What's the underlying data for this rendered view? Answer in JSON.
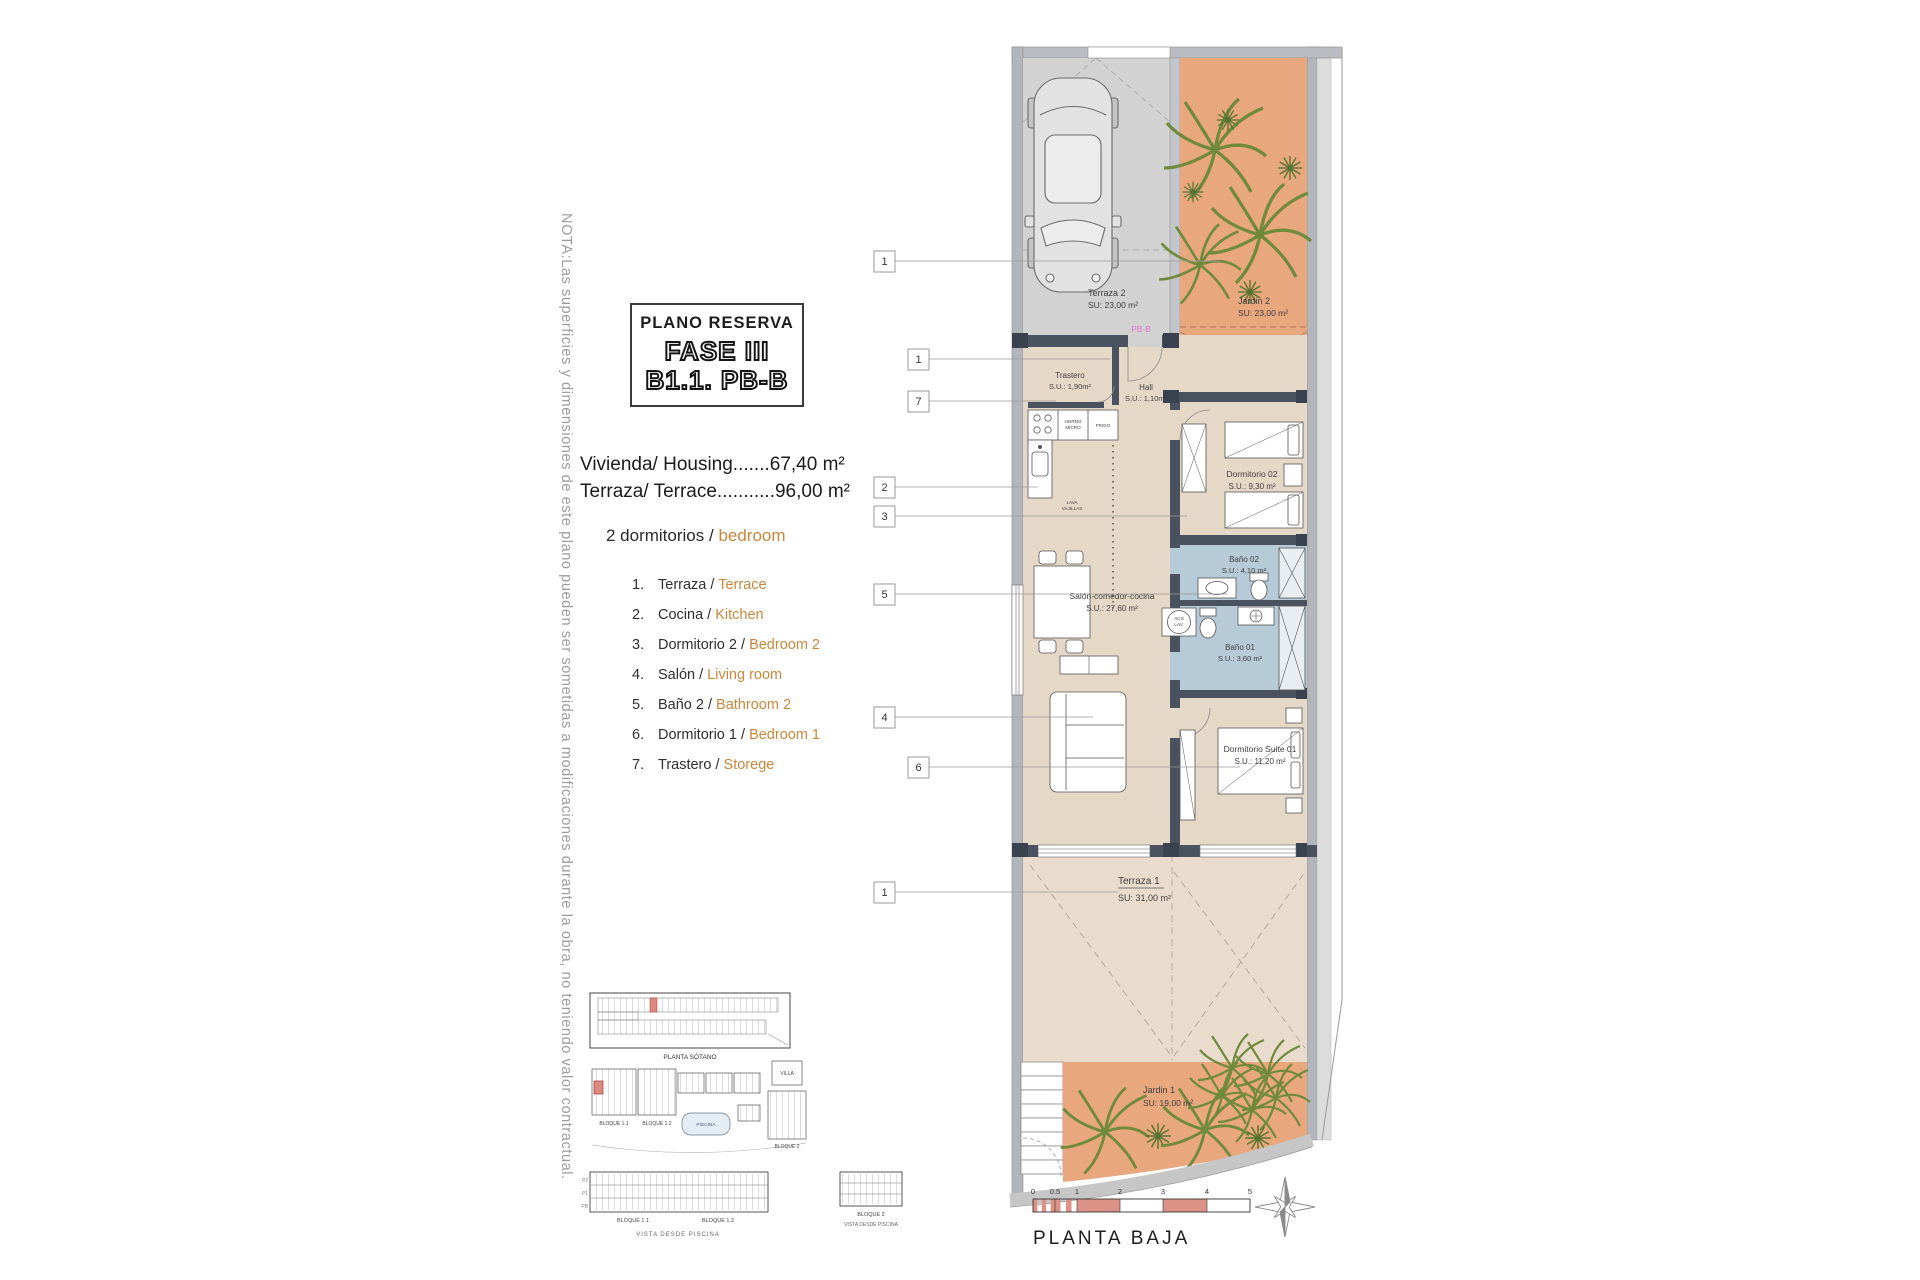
{
  "note": "NOTA:Las superficies y dimensiones de este plano pueden ser sometidas a modificaciones durante la obra, no teniendo valor contractual.",
  "title_block": {
    "line1": "PLANO RESERVA",
    "line2": "FASE III",
    "line3": "B1.1. PB-B"
  },
  "areas": {
    "housing": "Vivienda/ Housing.......67,40 m²",
    "terrace": "Terraza/ Terrace...........96,00 m²",
    "bedrooms_es": "2 dormitorios / ",
    "bedrooms_en": "bedroom"
  },
  "legend": [
    {
      "num": "1.",
      "es": "Terraza / ",
      "en": "Terrace"
    },
    {
      "num": "2.",
      "es": "Cocina / ",
      "en": "Kitchen"
    },
    {
      "num": "3.",
      "es": "Dormitorio 2 / ",
      "en": "Bedroom 2"
    },
    {
      "num": "4.",
      "es": "Salón / ",
      "en": "Living room"
    },
    {
      "num": "5.",
      "es": "Baño 2 / ",
      "en": "Bathroom 2"
    },
    {
      "num": "6.",
      "es": "Dormitorio 1 / ",
      "en": "Bedroom 1"
    },
    {
      "num": "7.",
      "es": "Trastero / ",
      "en": "Storege"
    }
  ],
  "plan": {
    "callouts": [
      "1",
      "1",
      "7",
      "2",
      "3",
      "5",
      "4",
      "6",
      "1"
    ],
    "labels": {
      "terraza2": {
        "name": "Terraza 2",
        "area": "SU: 23,00 m²"
      },
      "jardin2": {
        "name": "Jardin 2",
        "area": "SU: 23,00 m²"
      },
      "pbb": "PB-B",
      "trastero": {
        "name": "Trastero",
        "area": "S.U.: 1,90m²"
      },
      "hall": {
        "name": "Hall",
        "area": "S.U.: 1,10m²"
      },
      "horno_l1": "HORNO",
      "horno_l2": "MICRO",
      "frigo": "FRIGO",
      "lava_l1": "LAVA",
      "lava_l2": "VAJILLAS",
      "acs_l1": "ACS",
      "acs_l2": "LAV.",
      "dorm02": {
        "name": "Dormitorio 02",
        "area": "S.U.: 9,30 m²"
      },
      "bano02": {
        "name": "Baño 02",
        "area": "S.U.: 4,10 m²"
      },
      "bano01": {
        "name": "Baño 01",
        "area": "S.U.: 3,60 m²"
      },
      "salon": {
        "name": "Salón-comedor-cocina",
        "area": "S.U.: 27,60 m²"
      },
      "suite": {
        "name": "Dormitorio Suite 01",
        "area": "S.U.: 11,20 m²"
      },
      "terraza1": {
        "name": "Terraza 1",
        "area": "SU: 31,00 m²"
      },
      "jardin1": {
        "name": "Jardin 1",
        "area": "SU: 19,00 m²"
      }
    },
    "scale": {
      "ticks": [
        "0",
        "0.5",
        "1",
        "2",
        "3",
        "4",
        "5"
      ],
      "x_mark": "x",
      "caption": "PLANTA BAJA"
    }
  },
  "minimap": {
    "sotano": "PLANTA SÓTANO",
    "bloque11": "BLOQUE 1.1",
    "bloque12": "BLOQUE 1.2",
    "bloque2": "BLOQUE 2",
    "villa": "VILLA",
    "piscina": "PISCINA",
    "vista": "VISTA DESDE PISCINA",
    "floors": [
      "P2",
      "P1",
      "PB"
    ]
  },
  "palette": {
    "garden_orange": "#e9a77d",
    "interior_beige": "#e6d8c7",
    "terrace_beige": "#e9dccc",
    "bathroom_blue": "#b7cad7",
    "wall_dark": "#49525e",
    "parking_gray": "#d2d2d2",
    "scale_red": "#dd9287",
    "accent_text": "#c9873c",
    "pbb_pink": "#e473d4",
    "note_gray": "#9c9c9c"
  }
}
